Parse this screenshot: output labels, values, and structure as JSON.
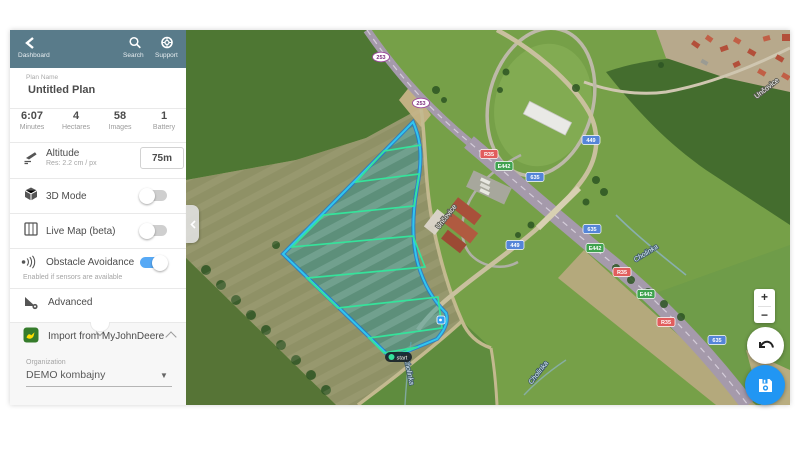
{
  "topbar": {
    "back_label": "Dashboard",
    "search_label": "Search",
    "support_label": "Support"
  },
  "plan": {
    "name_label": "Plan Name",
    "name_value": "Untitled Plan"
  },
  "stats": [
    {
      "value": "6:07",
      "label": "Minutes"
    },
    {
      "value": "4",
      "label": "Hectares"
    },
    {
      "value": "58",
      "label": "Images"
    },
    {
      "value": "1",
      "label": "Battery"
    }
  ],
  "settings": {
    "altitude": {
      "label": "Altitude",
      "sub": "Res: 2.2 cm / px",
      "value": "75m"
    },
    "mode3d": {
      "label": "3D Mode",
      "enabled": false
    },
    "livemap": {
      "label": "Live Map (beta)",
      "enabled": false
    },
    "obstacle": {
      "label": "Obstacle Avoidance",
      "sub": "Enabled if sensors are available",
      "enabled": true
    },
    "advanced": {
      "label": "Advanced"
    }
  },
  "import_jd": {
    "label": "Import from MyJohnDeere",
    "organization_label": "Organization",
    "organization_value": "DEMO kombajny"
  },
  "map": {
    "start_label": "start",
    "controls": {
      "zoom_in": "+",
      "zoom_out": "−"
    },
    "shields": [
      {
        "label": "253",
        "type": "oval"
      },
      {
        "label": "253",
        "type": "oval"
      },
      {
        "label": "R35",
        "type": "red"
      },
      {
        "label": "E442",
        "type": "green"
      },
      {
        "label": "635",
        "type": "blue"
      },
      {
        "label": "449",
        "type": "blue"
      },
      {
        "label": "635",
        "type": "blue"
      },
      {
        "label": "E442",
        "type": "green"
      },
      {
        "label": "449",
        "type": "blue"
      },
      {
        "label": "R35",
        "type": "red"
      },
      {
        "label": "E442",
        "type": "green"
      },
      {
        "label": "R35",
        "type": "red"
      },
      {
        "label": "635",
        "type": "blue"
      }
    ],
    "places": [
      {
        "label": "Unčovice",
        "kind": "street"
      },
      {
        "label": "Unčovice",
        "kind": "street"
      },
      {
        "label": "Cholinka",
        "kind": "stream"
      },
      {
        "label": "Cholinka",
        "kind": "stream"
      },
      {
        "label": "Cholinka",
        "kind": "stream"
      }
    ]
  },
  "colors": {
    "topbar_teal": "#597b8a",
    "toggle_on_blue": "#57a9f5",
    "save_blue": "#2196f3",
    "flight_outline_cyan": "#30c6f0",
    "flight_outline_blue": "#1976d2",
    "flight_fill_teal": "rgba(0,140,160,0.35)",
    "flight_lines_green": "#35e39b",
    "john_deere_green": "#367c2b",
    "john_deere_yellow": "#ffde00"
  }
}
